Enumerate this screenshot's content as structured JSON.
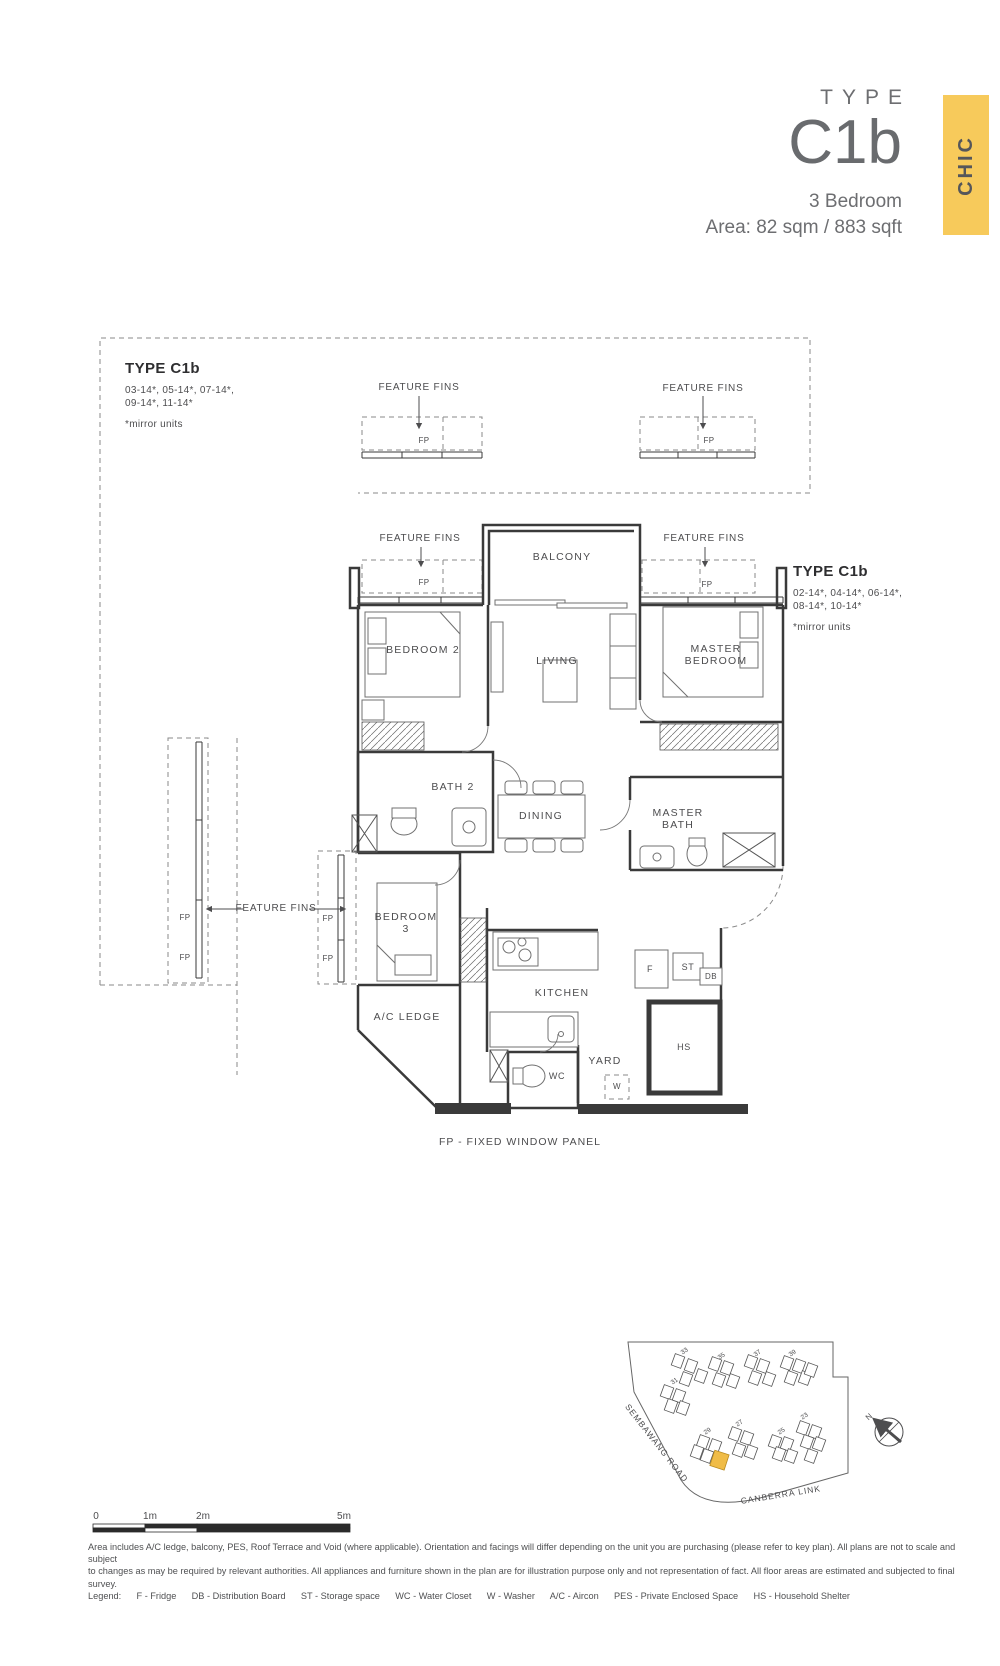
{
  "header": {
    "type_label": "TYPE",
    "type_code": "C1b",
    "bedroom": "3 Bedroom",
    "area": "Area: 82 sqm / 883 sqft",
    "collection": "CHIC",
    "accent_color": "#F7CA5B"
  },
  "unit_blocks": {
    "left": {
      "title": "TYPE C1b",
      "units1": "03-14*, 05-14*, 07-14*,",
      "units2": "09-14*, 11-14*",
      "note": "*mirror units"
    },
    "right": {
      "title": "TYPE C1b",
      "units1": "02-14*, 04-14*, 06-14*,",
      "units2": "08-14*, 10-14*",
      "note": "*mirror units"
    }
  },
  "plan": {
    "feature_fins": "FEATURE FINS",
    "fp": "FP",
    "fp_note": "FP - FIXED WINDOW PANEL",
    "rooms": {
      "balcony": "BALCONY",
      "bedroom2": "BEDROOM 2",
      "living": "LIVING",
      "master_bedroom_1": "MASTER",
      "master_bedroom_2": "BEDROOM",
      "bath2": "BATH 2",
      "dining": "DINING",
      "master_bath_1": "MASTER",
      "master_bath_2": "BATH",
      "bedroom3_1": "BEDROOM",
      "bedroom3_2": "3",
      "kitchen": "KITCHEN",
      "ac_ledge": "A/C LEDGE",
      "yard": "YARD",
      "wc": "WC",
      "hs": "HS",
      "f": "F",
      "st": "ST",
      "db": "DB",
      "w": "W"
    }
  },
  "site_map": {
    "road1": "SEMBAWANG ROAD",
    "road2": "CANBERRA LINK",
    "north": "N",
    "blocks": [
      "33",
      "35",
      "37",
      "39",
      "31",
      "29",
      "27",
      "25",
      "23"
    ],
    "highlight_color": "#F0BC47"
  },
  "scale_bar": {
    "t0": "0",
    "t1": "1m",
    "t2": "2m",
    "t3": "5m"
  },
  "footer": {
    "line1": "Area includes A/C ledge, balcony, PES, Roof Terrace and Void (where applicable). Orientation and facings will differ depending on the unit you are purchasing (please refer to key plan). All plans are not to scale and subject",
    "line2": "to changes as may be required by relevant authorities. All appliances and furniture shown in the plan are for illustration purpose only and not representation of fact. All floor areas are estimated and subjected to final survey.",
    "legend": "Legend:      F - Fridge      DB - Distribution Board      ST - Storage space      WC - Water Closet      W - Washer      A/C - Aircon      PES - Private Enclosed Space      HS - Household Shelter"
  }
}
